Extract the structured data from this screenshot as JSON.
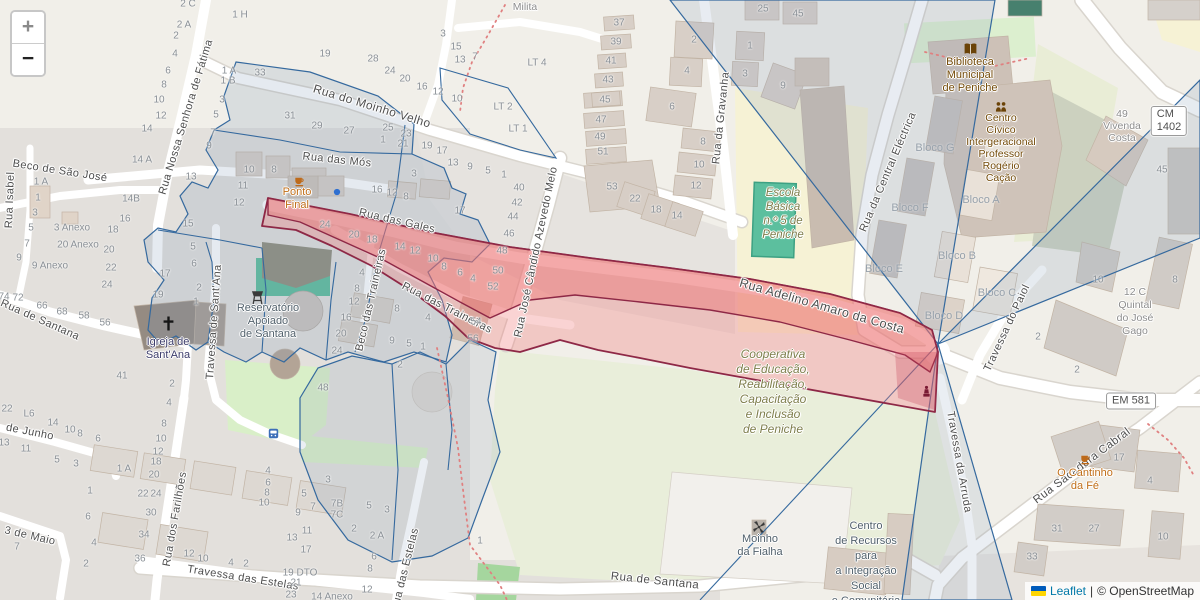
{
  "controls": {
    "zoom_in_label": "+",
    "zoom_out_label": "−"
  },
  "attribution": {
    "flag_top_color": "#005BBB",
    "flag_bottom_color": "#FFD500",
    "leaflet_link": "Leaflet",
    "separator": "|",
    "osm_text": "© OpenStreetMap"
  },
  "road_badges": [
    {
      "text": "CM 1402",
      "x": 1169,
      "y": 121
    },
    {
      "text": "EM 581",
      "x": 1131,
      "y": 401
    }
  ],
  "streets": [
    {
      "name": "Rua Nossa Senhora de Fátima",
      "x": 186,
      "y": 117,
      "rot": -73
    },
    {
      "name": "Beco de São José",
      "x": 60,
      "y": 171,
      "rot": 9
    },
    {
      "name": "Rua Isabel",
      "x": 10,
      "y": 200,
      "rot": -88
    },
    {
      "name": "Rua do Moinho Velho",
      "x": 372,
      "y": 106,
      "rot": 17,
      "fs": 12
    },
    {
      "name": "Rua das Mós",
      "x": 337,
      "y": 160,
      "rot": 6
    },
    {
      "name": "Rua das Gales",
      "x": 397,
      "y": 221,
      "rot": 13
    },
    {
      "name": "Rua das Traineiras",
      "x": 447,
      "y": 308,
      "rot": 27
    },
    {
      "name": "Beco das Traineiras",
      "x": 371,
      "y": 300,
      "rot": -77
    },
    {
      "name": "Rua José Cândido Azevedo Melo",
      "x": 536,
      "y": 252,
      "rot": -78
    },
    {
      "name": "Rua da Gravanha",
      "x": 721,
      "y": 118,
      "rot": -84
    },
    {
      "name": "Rua da Central Eléctrica",
      "x": 888,
      "y": 172,
      "rot": -67
    },
    {
      "name": "Rua Adelino Amaro da Costa",
      "x": 822,
      "y": 306,
      "rot": 16,
      "fs": 12.5
    },
    {
      "name": "Travessa do Paiol",
      "x": 1007,
      "y": 328,
      "rot": -65
    },
    {
      "name": "Travessa da Arruda",
      "x": 959,
      "y": 462,
      "rot": 80
    },
    {
      "name": "Rua Sacadura Cabral",
      "x": 1082,
      "y": 466,
      "rot": -37,
      "fs": 11.5
    },
    {
      "name": "Travessa de Sant'Ana",
      "x": 214,
      "y": 322,
      "rot": -86
    },
    {
      "name": "Rua de Santana",
      "x": 40,
      "y": 320,
      "rot": 24
    },
    {
      "name": "Rua de Santana",
      "x": 655,
      "y": 581,
      "rot": 6,
      "fs": 11.5
    },
    {
      "name": "Travessa das Estelas",
      "x": 243,
      "y": 578,
      "rot": 9
    },
    {
      "name": "Rua das Estelas",
      "x": 405,
      "y": 570,
      "rot": -76
    },
    {
      "name": "Rua dos Farilhões",
      "x": 175,
      "y": 519,
      "rot": -80
    },
    {
      "name": "de Junho",
      "x": 30,
      "y": 432,
      "rot": 11
    },
    {
      "name": "3 de Maio",
      "x": 30,
      "y": 536,
      "rot": 13
    }
  ],
  "block_labels": [
    {
      "text": "Bloco G",
      "x": 935,
      "y": 148
    },
    {
      "text": "Bloco F",
      "x": 910,
      "y": 208
    },
    {
      "text": "Bloco E",
      "x": 884,
      "y": 269
    },
    {
      "text": "Bloco A",
      "x": 981,
      "y": 200
    },
    {
      "text": "Bloco B",
      "x": 957,
      "y": 256
    },
    {
      "text": "Bloco C",
      "x": 997,
      "y": 293
    },
    {
      "text": "Bloco D",
      "x": 944,
      "y": 316
    }
  ],
  "pois": [
    {
      "id": "ponto-final",
      "lines": [
        "Ponto",
        "Final"
      ],
      "x": 297,
      "y": 192,
      "color": "#C06E18",
      "lh": 13,
      "fs": 11
    },
    {
      "id": "o-cantinho-da-fe",
      "lines": [
        "O Cantinho",
        "da Fé"
      ],
      "x": 1085,
      "y": 473,
      "color": "#C06E18",
      "lh": 13,
      "fs": 11
    },
    {
      "id": "biblioteca-municipal",
      "lines": [
        "Biblioteca",
        "Municipal",
        "de Peniche"
      ],
      "x": 970,
      "y": 62,
      "color": "#734A08",
      "lh": 13,
      "fs": 11
    },
    {
      "id": "centro-civico",
      "lines": [
        "Centro",
        "Cívico",
        "Intergeracional",
        "Professor",
        "Rogério",
        "Cação"
      ],
      "x": 1001,
      "y": 118,
      "color": "#734A08",
      "lh": 12,
      "fs": 10.5
    },
    {
      "id": "igreja-de-santana",
      "lines": [
        "Igreja de",
        "Sant'Ana"
      ],
      "x": 168,
      "y": 342,
      "color": "#3D3D6B",
      "lh": 13,
      "fs": 11
    },
    {
      "id": "reservatorio",
      "lines": [
        "Reservatório",
        "Apoiado",
        "de Santana"
      ],
      "x": 268,
      "y": 308,
      "color": "#51606B",
      "lh": 13,
      "fs": 11
    },
    {
      "id": "moinho-da-fialha",
      "lines": [
        "Moinho",
        "da Fialha"
      ],
      "x": 760,
      "y": 539,
      "color": "#51606B",
      "lh": 13,
      "fs": 11
    },
    {
      "id": "centro-de-recursos",
      "lines": [
        "Centro",
        "de Recursos",
        "para",
        "a Integração",
        "Social",
        "e Comunitária"
      ],
      "x": 866,
      "y": 526,
      "color": "#51606B",
      "lh": 15,
      "fs": 11
    },
    {
      "id": "escola-basica",
      "lines": [
        "Escola",
        "Básica",
        "n.º 5 de",
        "Peniche"
      ],
      "x": 783,
      "y": 193,
      "color": "#7E7E4B",
      "lh": 14,
      "fs": 11.5,
      "italic": true
    },
    {
      "id": "cooperativa",
      "lines": [
        "Cooperativa",
        "de Educação,",
        "Reabilitação,",
        "Capacitação",
        "e Inclusão",
        "de Peniche"
      ],
      "x": 773,
      "y": 354,
      "color": "#7E7E4B",
      "lh": 15,
      "fs": 12,
      "italic": true
    },
    {
      "id": "vivenda-milita",
      "lines": [
        "Vivenda",
        "Milita"
      ],
      "x": 525,
      "y": -5,
      "color": "#8D8D8D",
      "lh": 12,
      "fs": 10.5
    },
    {
      "id": "vivenda-costa",
      "lines": [
        "49",
        "Vivenda",
        "Costa"
      ],
      "x": 1122,
      "y": 114,
      "color": "#8D8D8D",
      "lh": 12,
      "fs": 10.5
    },
    {
      "id": "quintal-do-jose-gago",
      "lines": [
        "12 C",
        "Quintal",
        "do José",
        "Gago"
      ],
      "x": 1135,
      "y": 292,
      "color": "#8D8D8D",
      "lh": 13,
      "fs": 10.5
    }
  ],
  "icons": [
    {
      "name": "cafe-icon",
      "x": 299,
      "y": 181
    },
    {
      "name": "drinking-water-icon",
      "x": 337,
      "y": 192
    },
    {
      "name": "cafe-icon",
      "x": 1085,
      "y": 459
    },
    {
      "name": "book-icon",
      "x": 970,
      "y": 49
    },
    {
      "name": "community-icon",
      "x": 1001,
      "y": 107
    },
    {
      "name": "church-cross-icon",
      "x": 168,
      "y": 323
    },
    {
      "name": "water-tower-icon",
      "x": 257,
      "y": 297
    },
    {
      "name": "windmill-icon",
      "x": 759,
      "y": 527
    },
    {
      "name": "statue-icon",
      "x": 926,
      "y": 391
    },
    {
      "name": "bus-stop-icon",
      "x": 273,
      "y": 433
    }
  ],
  "house_numbers": [
    [
      "2 C",
      188,
      4
    ],
    [
      "1 H",
      240,
      15
    ],
    [
      "2 A",
      184,
      25
    ],
    [
      "2",
      176,
      36
    ],
    [
      "4",
      175,
      54
    ],
    [
      "6",
      168,
      71
    ],
    [
      "8",
      164,
      85
    ],
    [
      "10",
      159,
      100
    ],
    [
      "12",
      161,
      116
    ],
    [
      "14",
      147,
      129
    ],
    [
      "14 A",
      142,
      160
    ],
    [
      "1 A",
      229,
      71
    ],
    [
      "1 B",
      228,
      81
    ],
    [
      "3",
      222,
      100
    ],
    [
      "5",
      216,
      115
    ],
    [
      "7",
      213,
      133
    ],
    [
      "9",
      209,
      146
    ],
    [
      "13",
      191,
      177
    ],
    [
      "15",
      188,
      224
    ],
    [
      "5",
      193,
      247
    ],
    [
      "6",
      194,
      264
    ],
    [
      "17",
      165,
      274
    ],
    [
      "19",
      158,
      295
    ],
    [
      "1 A",
      41,
      182
    ],
    [
      "1",
      38,
      198
    ],
    [
      "3",
      35,
      213
    ],
    [
      "5",
      31,
      228
    ],
    [
      "7",
      27,
      244
    ],
    [
      "9",
      19,
      258
    ],
    [
      "3 Anexo",
      72,
      228
    ],
    [
      "20 Anexo",
      78,
      245
    ],
    [
      "9 Anexo",
      50,
      266
    ],
    [
      "14B",
      131,
      199
    ],
    [
      "16",
      125,
      219
    ],
    [
      "18",
      113,
      230
    ],
    [
      "20",
      109,
      250
    ],
    [
      "22",
      111,
      268
    ],
    [
      "24",
      107,
      285
    ],
    [
      "74",
      4,
      297
    ],
    [
      "72",
      18,
      298
    ],
    [
      "66",
      42,
      306
    ],
    [
      "68",
      62,
      312
    ],
    [
      "58",
      84,
      316
    ],
    [
      "56",
      105,
      323
    ],
    [
      "19",
      325,
      54
    ],
    [
      "33",
      260,
      73
    ],
    [
      "31",
      290,
      116
    ],
    [
      "29",
      317,
      126
    ],
    [
      "27",
      349,
      131
    ],
    [
      "25",
      388,
      128
    ],
    [
      "23",
      406,
      134
    ],
    [
      "21",
      403,
      144
    ],
    [
      "1",
      383,
      140
    ],
    [
      "19",
      427,
      146
    ],
    [
      "17",
      442,
      151
    ],
    [
      "13",
      453,
      163
    ],
    [
      "9",
      470,
      167
    ],
    [
      "5",
      488,
      171
    ],
    [
      "1",
      504,
      175
    ],
    [
      "28",
      373,
      59
    ],
    [
      "24",
      390,
      71
    ],
    [
      "20",
      405,
      79
    ],
    [
      "16",
      422,
      87
    ],
    [
      "12",
      438,
      92
    ],
    [
      "10",
      457,
      99
    ],
    [
      "15",
      456,
      47
    ],
    [
      "13",
      460,
      60
    ],
    [
      "7",
      475,
      57
    ],
    [
      "3",
      443,
      34
    ],
    [
      "10",
      249,
      170
    ],
    [
      "8",
      274,
      170
    ],
    [
      "11",
      243,
      186
    ],
    [
      "12",
      239,
      203
    ],
    [
      "16",
      377,
      190
    ],
    [
      "12",
      392,
      193
    ],
    [
      "8",
      406,
      197
    ],
    [
      "3",
      414,
      174
    ],
    [
      "17",
      460,
      211
    ],
    [
      "LT 4",
      537,
      63
    ],
    [
      "LT 2",
      503,
      107
    ],
    [
      "LT 1",
      518,
      129
    ],
    [
      "24",
      325,
      225
    ],
    [
      "20",
      354,
      235
    ],
    [
      "18",
      372,
      240
    ],
    [
      "14",
      400,
      247
    ],
    [
      "12",
      415,
      251
    ],
    [
      "10",
      433,
      259
    ],
    [
      "8",
      444,
      267
    ],
    [
      "6",
      460,
      273
    ],
    [
      "4",
      473,
      279
    ],
    [
      "48",
      502,
      251
    ],
    [
      "50",
      498,
      271
    ],
    [
      "52",
      493,
      287
    ],
    [
      "54",
      476,
      322
    ],
    [
      "56",
      473,
      339
    ],
    [
      "40",
      519,
      188
    ],
    [
      "42",
      517,
      203
    ],
    [
      "44",
      513,
      217
    ],
    [
      "46",
      509,
      234
    ],
    [
      "4",
      362,
      273
    ],
    [
      "8",
      357,
      289
    ],
    [
      "12",
      354,
      302
    ],
    [
      "16",
      346,
      318
    ],
    [
      "20",
      341,
      334
    ],
    [
      "24",
      337,
      351
    ],
    [
      "8",
      397,
      309
    ],
    [
      "4",
      428,
      318
    ],
    [
      "9",
      392,
      341
    ],
    [
      "5",
      409,
      344
    ],
    [
      "1",
      423,
      347
    ],
    [
      "2",
      400,
      365
    ],
    [
      "41",
      122,
      376
    ],
    [
      "2",
      172,
      384
    ],
    [
      "48",
      323,
      388
    ],
    [
      "2",
      199,
      288
    ],
    [
      "1",
      196,
      302
    ],
    [
      "45",
      605,
      100
    ],
    [
      "47",
      601,
      120
    ],
    [
      "49",
      600,
      137
    ],
    [
      "51",
      603,
      152
    ],
    [
      "53",
      612,
      187
    ],
    [
      "22",
      635,
      199
    ],
    [
      "18",
      656,
      210
    ],
    [
      "14",
      677,
      216
    ],
    [
      "37",
      619,
      23
    ],
    [
      "39",
      616,
      42
    ],
    [
      "41",
      611,
      61
    ],
    [
      "43",
      608,
      80
    ],
    [
      "2",
      694,
      40
    ],
    [
      "4",
      687,
      71
    ],
    [
      "6",
      672,
      107
    ],
    [
      "8",
      703,
      142
    ],
    [
      "10",
      699,
      165
    ],
    [
      "12",
      696,
      186
    ],
    [
      "1",
      750,
      46
    ],
    [
      "3",
      745,
      74
    ],
    [
      "9",
      783,
      86
    ],
    [
      "25",
      763,
      9
    ],
    [
      "45",
      798,
      14
    ],
    [
      "45",
      1162,
      170
    ],
    [
      "10",
      1098,
      280
    ],
    [
      "8",
      1175,
      280
    ],
    [
      "2",
      1038,
      337
    ],
    [
      "2",
      1077,
      370
    ],
    [
      "17",
      1119,
      458
    ],
    [
      "4",
      1150,
      481
    ],
    [
      "31",
      1057,
      529
    ],
    [
      "27",
      1094,
      529
    ],
    [
      "33",
      1032,
      557
    ],
    [
      "10",
      1163,
      537
    ],
    [
      "22",
      7,
      409
    ],
    [
      "L6",
      29,
      414
    ],
    [
      "14",
      53,
      423
    ],
    [
      "10",
      70,
      430
    ],
    [
      "8",
      80,
      434
    ],
    [
      "6",
      98,
      439
    ],
    [
      "13",
      4,
      443
    ],
    [
      "11",
      26,
      449
    ],
    [
      "5",
      57,
      460
    ],
    [
      "3",
      76,
      464
    ],
    [
      "1 A",
      124,
      469
    ],
    [
      "1",
      90,
      491
    ],
    [
      "6",
      88,
      517
    ],
    [
      "4",
      94,
      543
    ],
    [
      "2",
      86,
      564
    ],
    [
      "7",
      17,
      547
    ],
    [
      "4",
      169,
      403
    ],
    [
      "8",
      164,
      424
    ],
    [
      "10",
      161,
      439
    ],
    [
      "12",
      158,
      452
    ],
    [
      "18",
      156,
      462
    ],
    [
      "20",
      154,
      475
    ],
    [
      "22",
      143,
      494
    ],
    [
      "24",
      156,
      494
    ],
    [
      "30",
      151,
      513
    ],
    [
      "34",
      144,
      535
    ],
    [
      "36",
      140,
      559
    ],
    [
      "12",
      189,
      554
    ],
    [
      "10",
      203,
      559
    ],
    [
      "4",
      231,
      563
    ],
    [
      "2",
      246,
      564
    ],
    [
      "4",
      268,
      471
    ],
    [
      "6",
      268,
      483
    ],
    [
      "8",
      267,
      493
    ],
    [
      "10",
      264,
      503
    ],
    [
      "3",
      328,
      480
    ],
    [
      "5",
      304,
      494
    ],
    [
      "7",
      313,
      507
    ],
    [
      "9",
      298,
      513
    ],
    [
      "7B",
      337,
      504
    ],
    [
      "7C",
      337,
      515
    ],
    [
      "11",
      307,
      531
    ],
    [
      "13",
      292,
      538
    ],
    [
      "17",
      306,
      550
    ],
    [
      "19 DTO",
      300,
      573
    ],
    [
      "21",
      296,
      583
    ],
    [
      "23",
      291,
      595
    ],
    [
      "2",
      354,
      529
    ],
    [
      "2 A",
      377,
      536
    ],
    [
      "5",
      369,
      506
    ],
    [
      "3",
      387,
      510
    ],
    [
      "6",
      374,
      557
    ],
    [
      "8",
      370,
      569
    ],
    [
      "12",
      367,
      590
    ],
    [
      "14 Anexo",
      332,
      597
    ],
    [
      "1",
      480,
      541
    ]
  ],
  "colors": {
    "background": "#F1EFE9",
    "residential": "#E3E0DC",
    "road": "#FFFFFF",
    "building": "#D8CFC7",
    "school": "#F6F2D5",
    "grass": "#D9EFC8",
    "pitch": "#5CBF9E",
    "parcel_line": "#35699E",
    "parcel_fill": "rgba(125,150,180,0.20)",
    "highlight_fill": "rgba(240,128,128,0.38)",
    "highlight_stroke": "#8E2846",
    "cafe_label": "#C06E18",
    "amenity_label": "#734A08",
    "landuse_label": "#7E7E4B",
    "housenumber": "#8A9096",
    "water_point": "#2E6FD0"
  }
}
